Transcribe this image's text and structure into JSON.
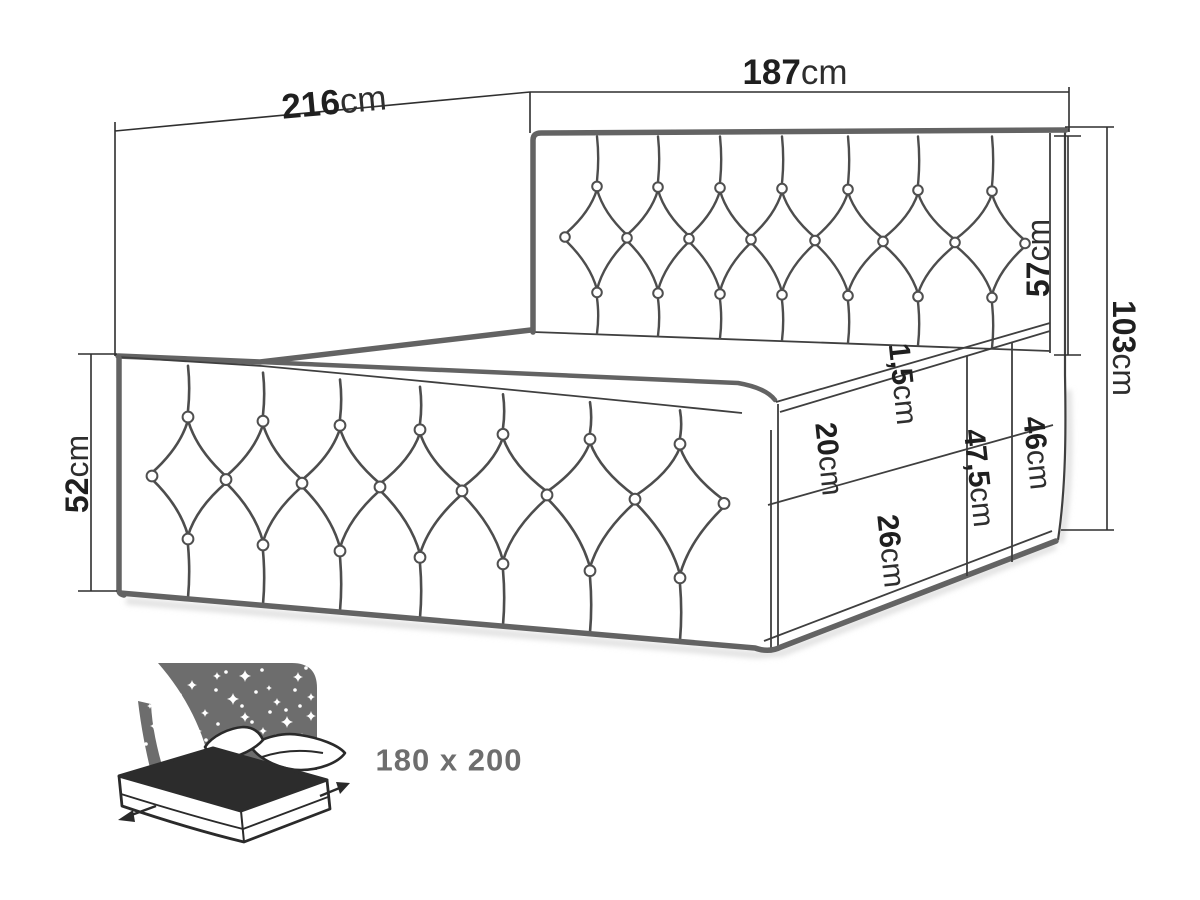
{
  "diagram_title": "bed-dimension-technical-drawing",
  "dimensions": {
    "side_length": {
      "value": "216",
      "unit": "cm"
    },
    "headboard_width": {
      "value": "187",
      "unit": "cm"
    },
    "headboard_height": {
      "value": "57",
      "unit": "cm"
    },
    "total_height": {
      "value": "103",
      "unit": "cm"
    },
    "front_panel_height": {
      "value": "52",
      "unit": "cm"
    },
    "mattress_seam": {
      "value": "1,5",
      "unit": "cm"
    },
    "base_upper_section": {
      "value": "20",
      "unit": "cm"
    },
    "base_side_height": {
      "value": "47,5",
      "unit": "cm"
    },
    "base_rear_height": {
      "value": "46",
      "unit": "cm"
    },
    "base_lower_section": {
      "value": "26",
      "unit": "cm"
    }
  },
  "badge": {
    "size_label": "180 x 200"
  },
  "colors": {
    "background": "#ffffff",
    "line": "#3f3f3f",
    "thick_edge": "#636363",
    "dimension_line": "#2f2f2f",
    "label_text": "#1f1f1f",
    "icon_gray": "#6d6d6d",
    "icon_dark": "#2c2c2c",
    "badge_text": "#6e6e6e"
  }
}
